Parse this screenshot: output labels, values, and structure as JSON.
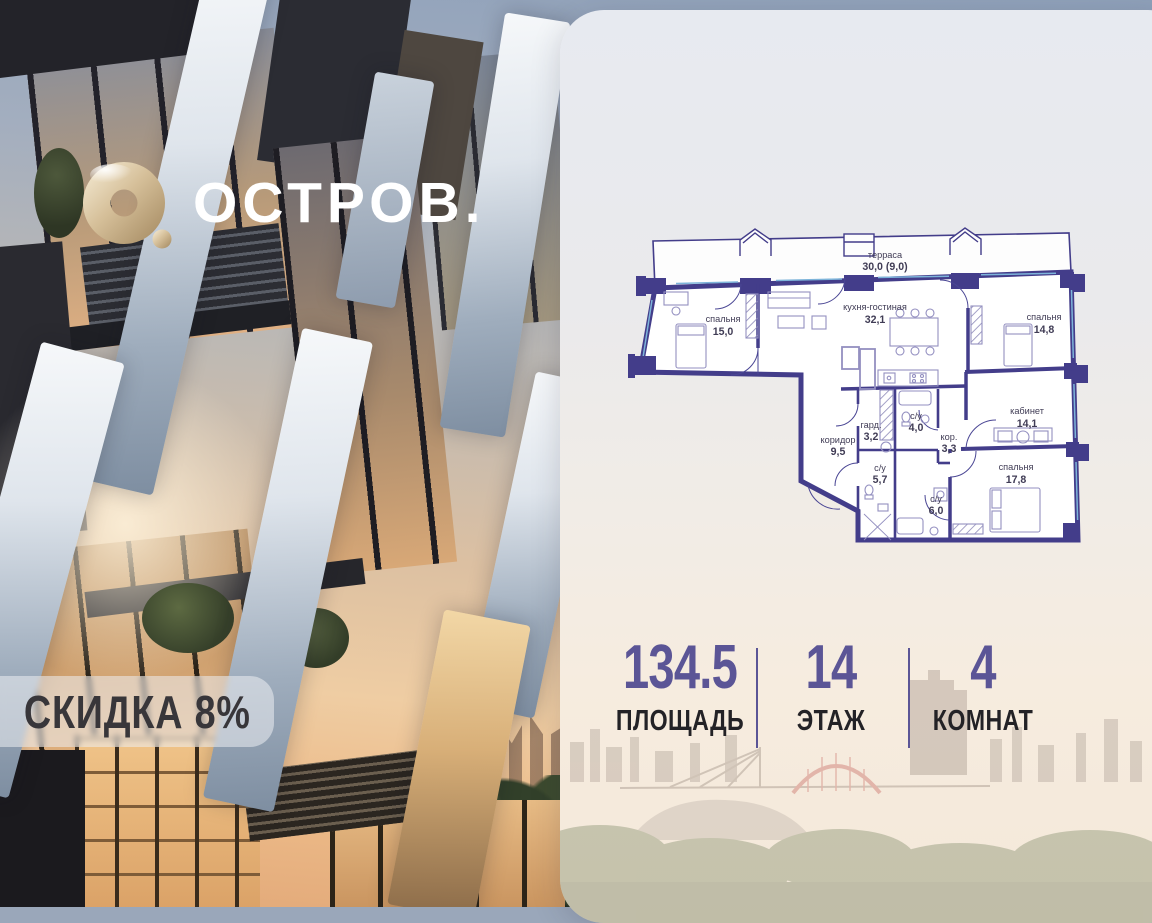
{
  "brand": {
    "wordmark": "ОСТРОВ.",
    "mark": "gold-torus-o"
  },
  "badge": {
    "label": "СКИДКА 8%"
  },
  "plan": {
    "rooms": [
      {
        "name": "терраса",
        "area": "30,0 (9,0)"
      },
      {
        "name": "спальня",
        "area": "15,0"
      },
      {
        "name": "кухня-гостиная",
        "area": "32,1"
      },
      {
        "name": "спальня",
        "area": "14,8"
      },
      {
        "name": "кабинет",
        "area": "14,1"
      },
      {
        "name": "коридор",
        "area": "9,5"
      },
      {
        "name": "гард.",
        "area": "3,2"
      },
      {
        "name": "с/у",
        "area": "4,0"
      },
      {
        "name": "кор.",
        "area": "3,3"
      },
      {
        "name": "с/у",
        "area": "5,7"
      },
      {
        "name": "с/у",
        "area": "6,0"
      },
      {
        "name": "спальня",
        "area": "17,8"
      }
    ]
  },
  "stats": [
    {
      "value": "134.5",
      "label": "ПЛОЩАДЬ"
    },
    {
      "value": "14",
      "label": "ЭТАЖ"
    },
    {
      "value": "4",
      "label": "КОМНАТ"
    }
  ],
  "colors": {
    "plan_walls": "#433d8a",
    "stat_accent": "#5b5596",
    "logo_gold": "#cbb186",
    "badge_text": "#38363a"
  }
}
